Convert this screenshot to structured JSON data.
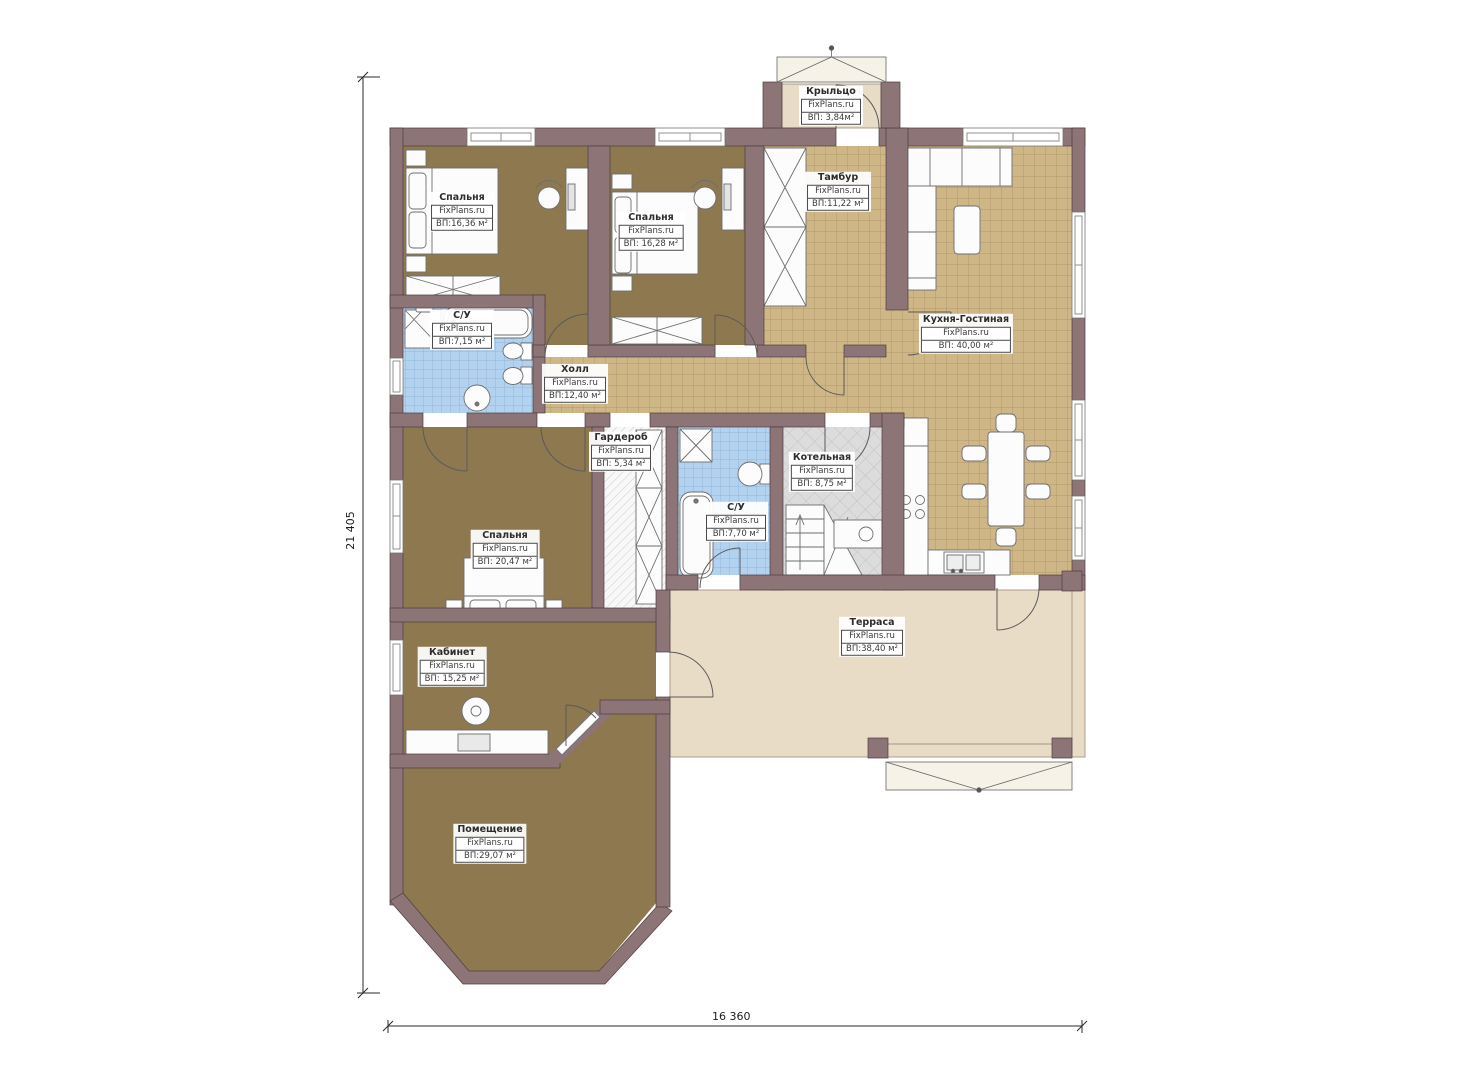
{
  "title": "Floor plan",
  "watermark": "FixPlans.ru",
  "dimensions": {
    "height_label": "21 405",
    "width_label": "16 360"
  },
  "rooms": [
    {
      "id": "bedroom-1",
      "name": "Спальня",
      "area": "ВП:16,36 м²"
    },
    {
      "id": "bedroom-2",
      "name": "Спальня",
      "area": "ВП: 16,28 м²"
    },
    {
      "id": "vestibule",
      "name": "Тамбур",
      "area": "ВП:11,22 м²"
    },
    {
      "id": "porch",
      "name": "Крыльцо",
      "area": "ВП: 3,84м²"
    },
    {
      "id": "kitchen-living",
      "name": "Кухня-Гостиная",
      "area": "ВП: 40,00 м²"
    },
    {
      "id": "bathroom-1",
      "name": "С/У",
      "area": "ВП:7,15 м²"
    },
    {
      "id": "hall",
      "name": "Холл",
      "area": "ВП:12,40 м²"
    },
    {
      "id": "wardrobe",
      "name": "Гардероб",
      "area": "ВП: 5,34 м²"
    },
    {
      "id": "bathroom-2",
      "name": "С/У",
      "area": "ВП:7,70 м²"
    },
    {
      "id": "boiler-room",
      "name": "Котельная",
      "area": "ВП: 8,75 м²"
    },
    {
      "id": "bedroom-3",
      "name": "Спальня",
      "area": "ВП: 20,47 м²"
    },
    {
      "id": "terrace",
      "name": "Терраса",
      "area": "ВП:38,40 м²"
    },
    {
      "id": "office",
      "name": "Кабинет",
      "area": "ВП: 15,25 м²"
    },
    {
      "id": "utility-room",
      "name": "Помещение",
      "area": "ВП:29,07 м²"
    }
  ],
  "colors": {
    "wall": "#8d7476",
    "wall_edge": "#4e3e40",
    "floor_wood": "#8d7850",
    "tile_tan": "#cfb687",
    "tile_blue": "#b3d2ef",
    "tile_gray": "#dcdcdc",
    "terrace": "#e8dcc7"
  }
}
